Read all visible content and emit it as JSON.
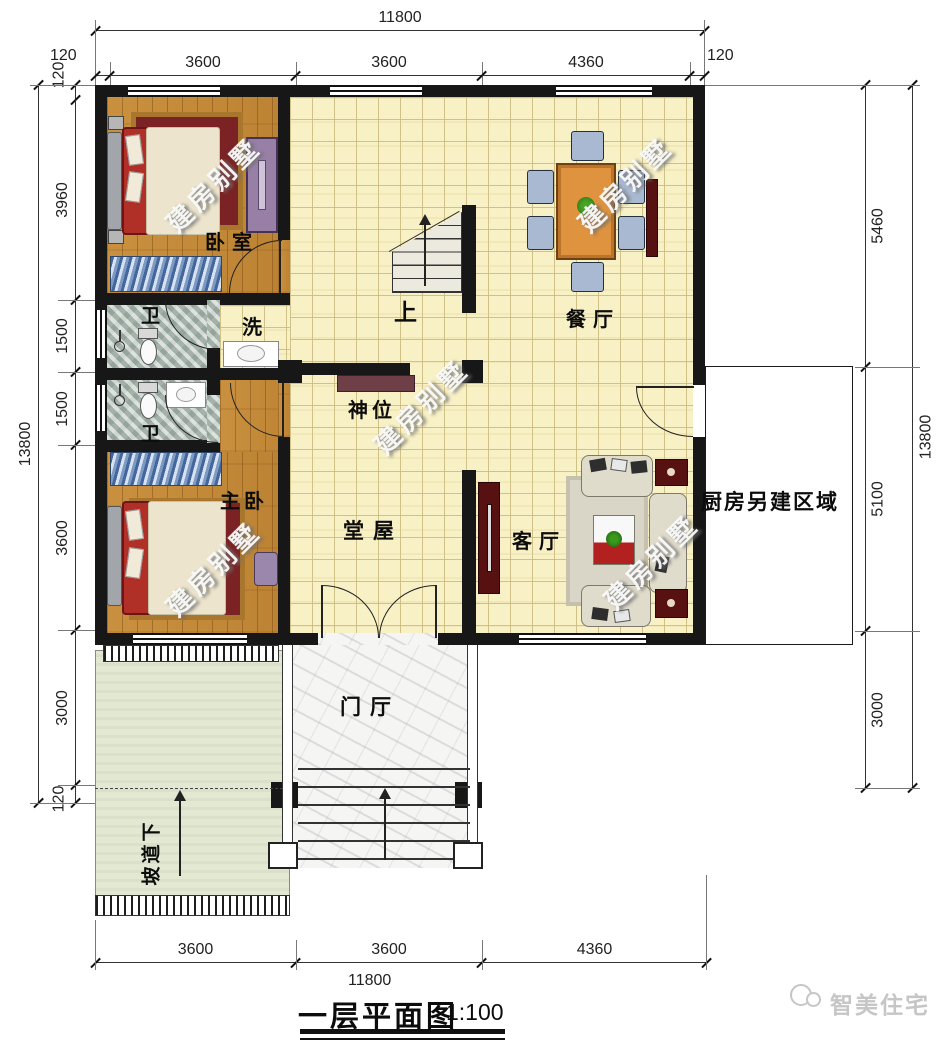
{
  "title": {
    "name": "一层平面图",
    "scale": "1:100"
  },
  "branding": {
    "logo_text": "智美住宅"
  },
  "watermark": {
    "text": "建房别墅"
  },
  "dimensions": {
    "top_total": "11800",
    "top_segments": [
      "120",
      "3600",
      "3600",
      "4360",
      "120"
    ],
    "bottom_segments": [
      "3600",
      "3600",
      "4360"
    ],
    "bottom_total": "11800",
    "left_total": "13800",
    "left_segments": [
      "120",
      "3960",
      "1500",
      "1500",
      "3600",
      "3000",
      "120"
    ],
    "right_segments": [
      "5460",
      "5100",
      "3000"
    ],
    "right_total": "13800"
  },
  "rooms": {
    "bedroom": "卧室",
    "bath_upper": "卫",
    "wash": "洗",
    "bath_lower": "卫",
    "master_bedroom": "主卧",
    "hall": "堂屋",
    "shrine": "神位",
    "stairs_up": "上",
    "dining": "餐厅",
    "living": "客厅",
    "kitchen_area": "厨房另建区域",
    "foyer": "门厅",
    "ramp": "坡道下"
  },
  "colors": {
    "wall": "#171717",
    "tile_floor": "#f8f1c6",
    "wood_floor": "#c9913f",
    "stone_floor": "#b9c4bc",
    "marble_floor": "#f5f5f4",
    "ramp_green": "#e3e8d3",
    "bed_red": "#b03028",
    "dining_table": "#e0933e",
    "chair_blue": "#a9b9d1",
    "cabinet_dark_red": "#571111",
    "shrine_maroon": "#6f3f48",
    "logo_gray": "#c6c6c6"
  }
}
